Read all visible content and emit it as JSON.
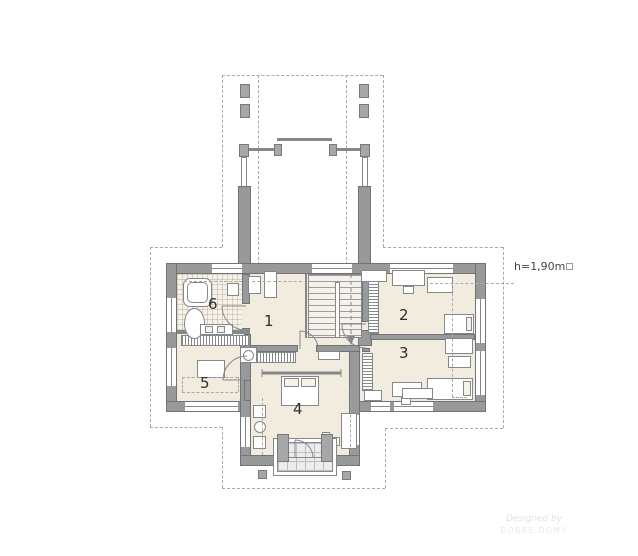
{
  "plan": {
    "height_note": "h=1,90m",
    "rooms": [
      {
        "number": "1"
      },
      {
        "number": "2"
      },
      {
        "number": "3"
      },
      {
        "number": "4"
      },
      {
        "number": "5"
      },
      {
        "number": "6"
      }
    ],
    "watermark": {
      "line1": "Designed by",
      "line2": "DOBRE DOMY"
    },
    "colors": {
      "wall": "#97999b",
      "floor": "#f2ecdf",
      "tile_floor": "#f7f2e8",
      "dashed_line": "#a9a9a9",
      "furniture_stroke": "#85888b",
      "balcony_floor": "#ececec",
      "label_text": "#2f2f2f"
    }
  }
}
